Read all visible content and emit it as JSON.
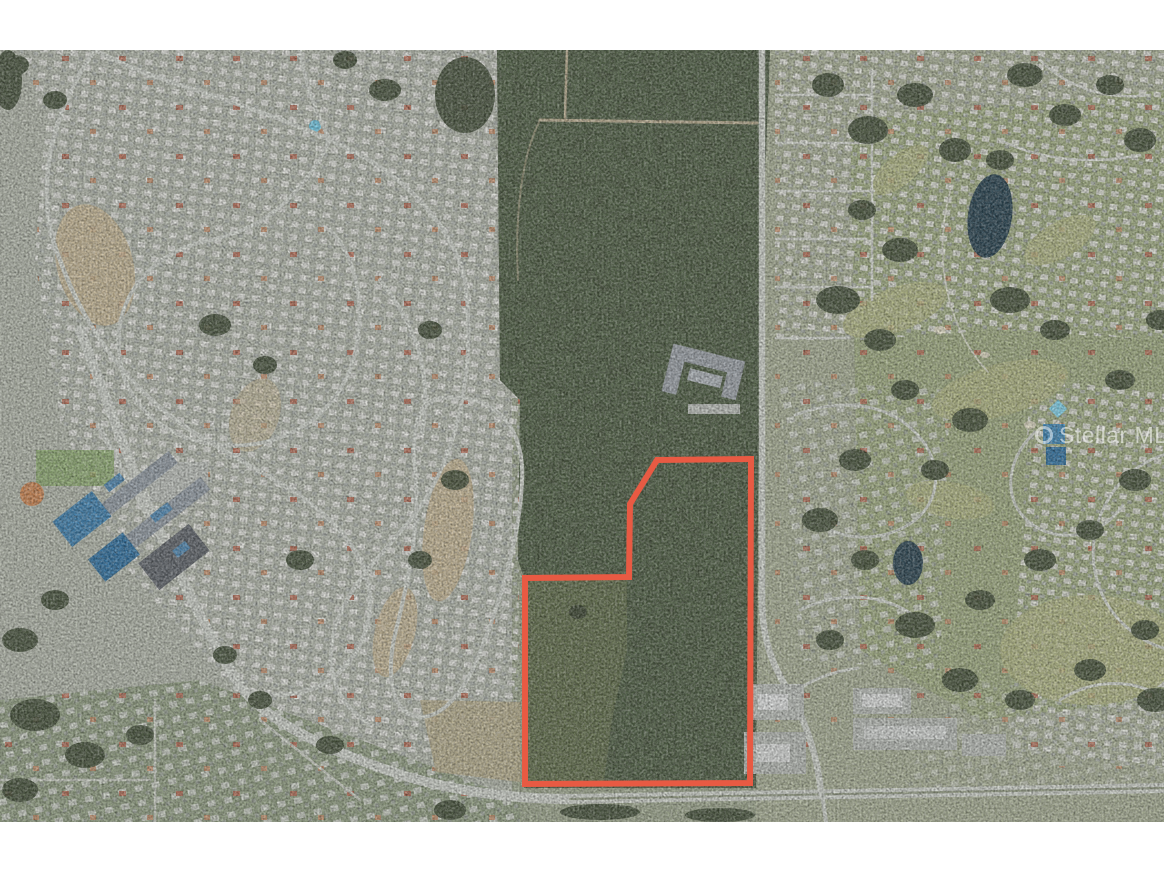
{
  "watermark": {
    "text": "Stellar MLS",
    "logo": "circle-ring-icon",
    "color": "#ffffff",
    "opacity": 0.55
  },
  "parcel": {
    "outline_color": "#e85a43",
    "stroke_width": 6,
    "points": "657,460 751,459 750,783 525,784 525,578 629,577 630,504",
    "shape": "irregular-polygon-with-notched-northwest-corner"
  },
  "scene": {
    "type": "aerial-satellite-photo",
    "features": [
      "suburban-neighborhood-loops-west",
      "wooded-parcel-center",
      "school-campus-with-blue-courts",
      "golf-course-and-ponds-east",
      "vertical-arterial-road",
      "divided-highway-south",
      "commercial-lots-southeast",
      "cleared-sand-patches"
    ],
    "colors": {
      "letterbox": "#ffffff",
      "field_base": "#99a289",
      "forest": "#3e4a33",
      "suburb_roofs": "#d9dad4",
      "road": "#ccd0c8",
      "water": "#26404d",
      "sand": "#c3b28d"
    }
  }
}
